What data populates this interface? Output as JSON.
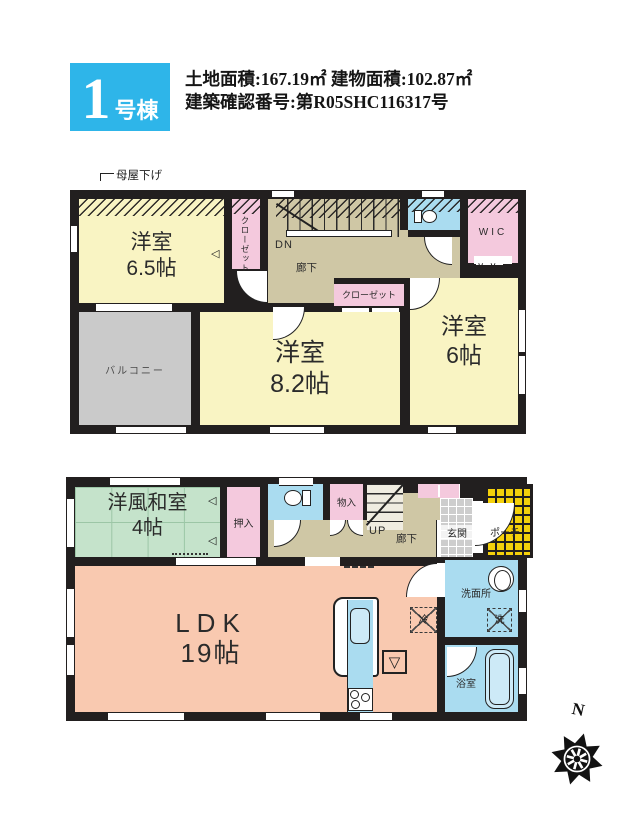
{
  "palette": {
    "wall": "#221f1f",
    "header_cyan": "#2eb5e9",
    "room_yellow": "#f9f4c3",
    "closet_pink": "#f4c9dd",
    "hall_beige": "#cfc7a5",
    "water_blue": "#aadcf0",
    "tatami_green": "#c5e3cb",
    "ldk_salmon": "#f9c9b0",
    "balcony_gray": "#cacaca",
    "porch_yellow": "#f5d10b",
    "entry_tile_gray": "#cdcdcd"
  },
  "header": {
    "unit_number": "1",
    "unit_suffix": "号棟",
    "area_line": "土地面積:167.19㎡ 建物面積:102.87㎡",
    "permit_line": "建築確認番号:第R05SHC116317号"
  },
  "floor2": {
    "roof_note": "母屋下げ",
    "room65_name": "洋室",
    "room65_size": "6.5帖",
    "closet_vertical": "クローゼット",
    "stairs_label": "DN",
    "hallway": "廊下",
    "wic": "WIC",
    "closet": "クローゼット",
    "room82_name": "洋室",
    "room82_size": "8.2帖",
    "room6_name": "洋室",
    "room6_size": "6帖",
    "balcony": "バルコニー"
  },
  "floor1": {
    "washitsu_name": "洋風和室",
    "washitsu_size": "4帖",
    "oshiire": "押入",
    "monoire": "物入",
    "stairs_label": "UP",
    "hallway": "廊下",
    "genkan": "玄関",
    "porch": "ポーチ",
    "ldk_name": "LDK",
    "ldk_size": "19帖",
    "fridge": "冷",
    "washroom": "洗面所",
    "laundry": "洗",
    "bath": "浴室"
  },
  "compass": {
    "north": "N"
  }
}
